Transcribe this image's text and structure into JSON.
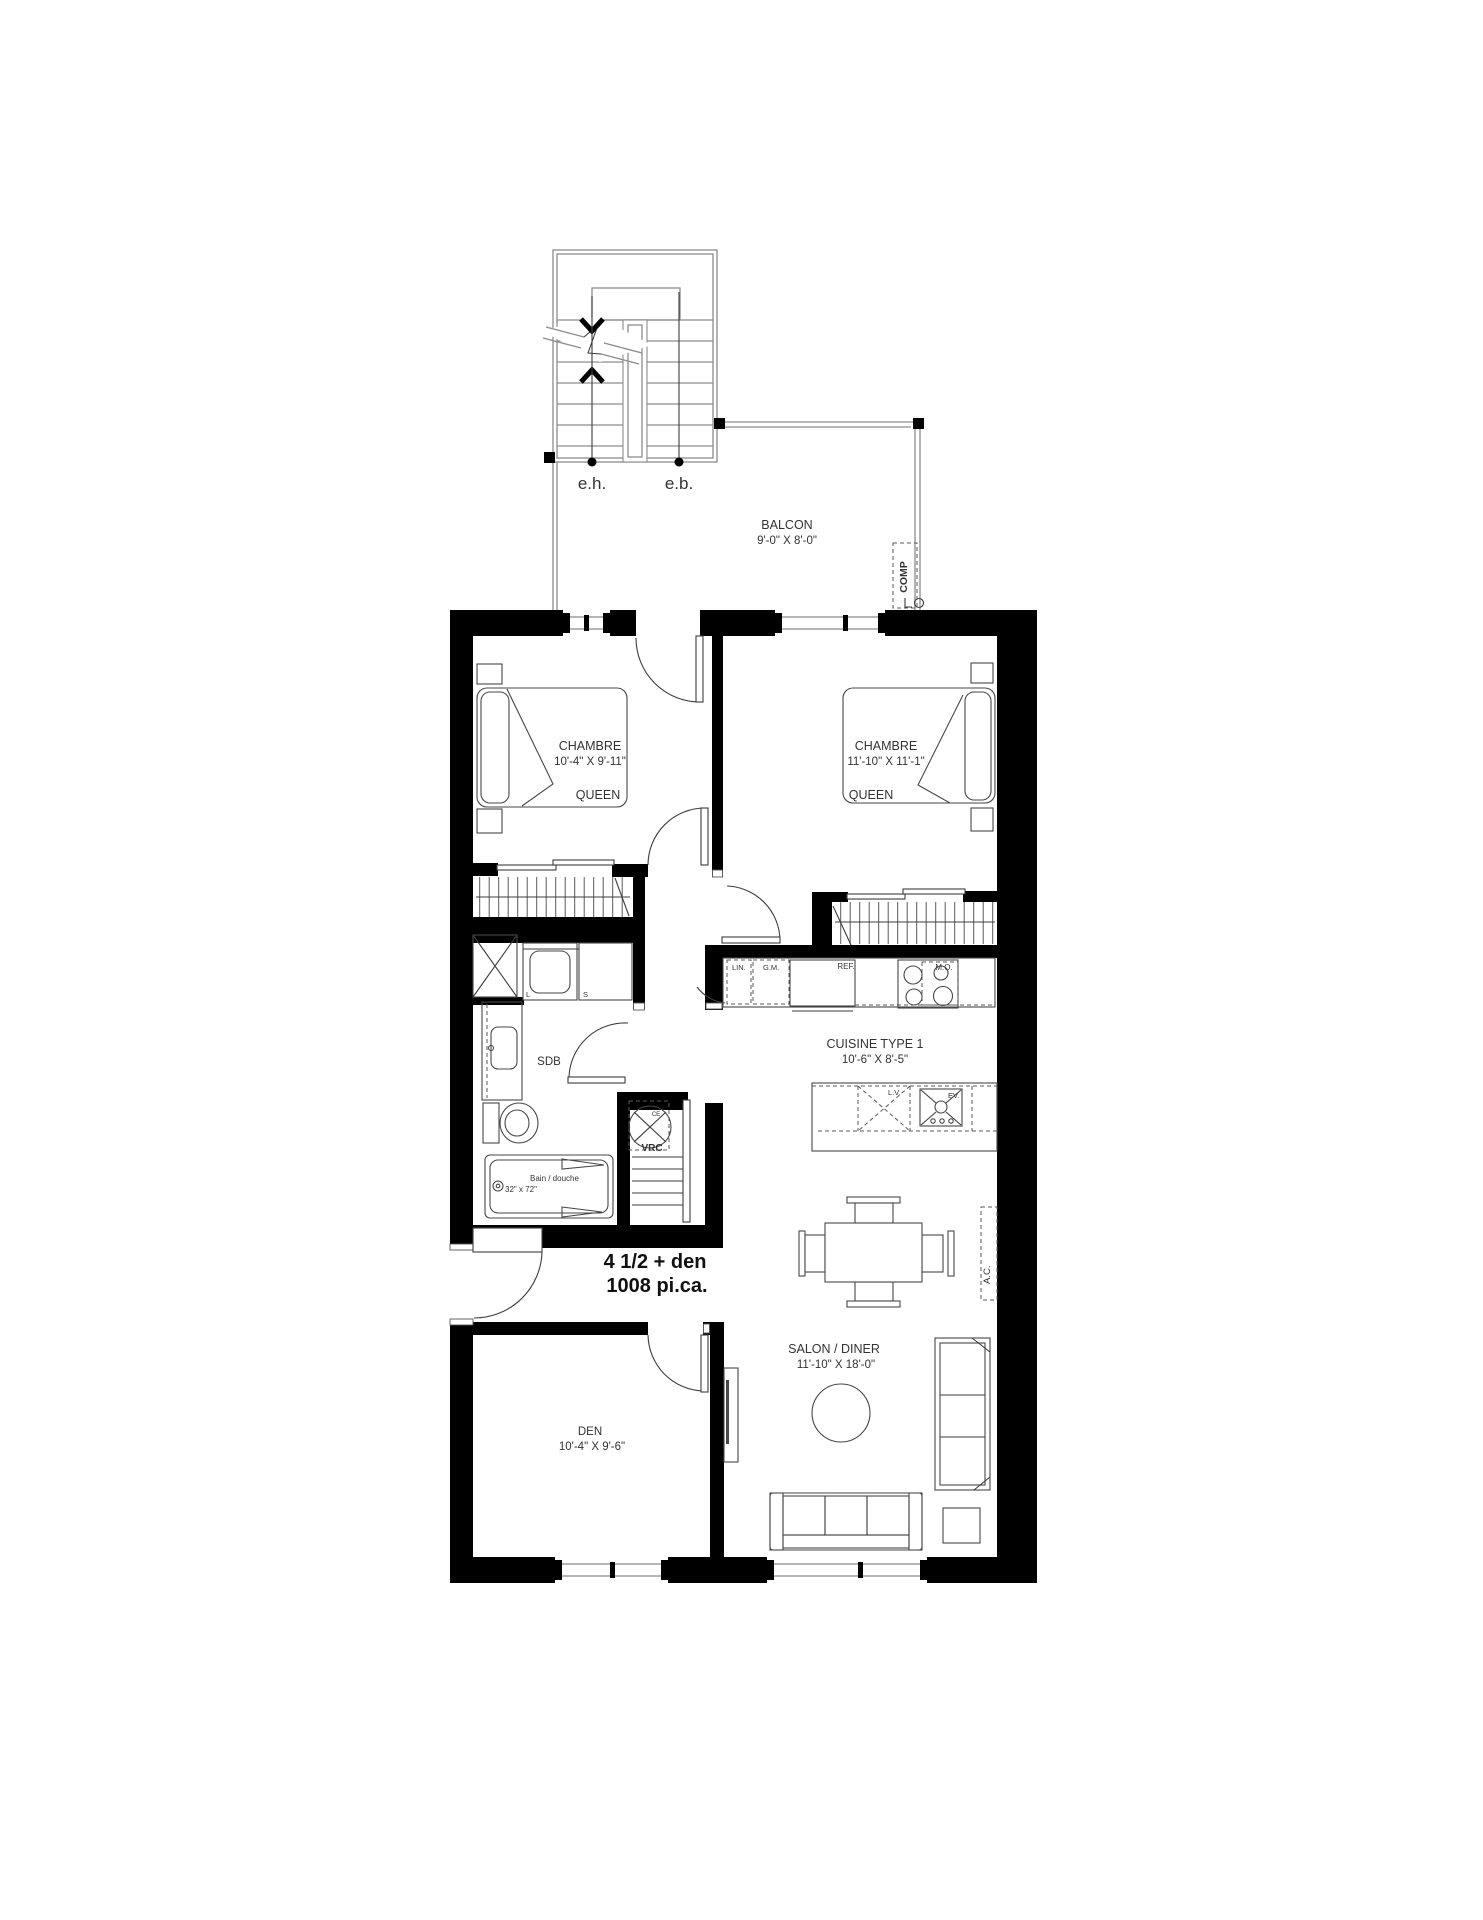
{
  "stairs": {
    "up_label": "e.h.",
    "down_label": "e.b."
  },
  "balcony": {
    "label": "BALCON",
    "dims": "9'-0\" X 8'-0\"",
    "comp": "COMP"
  },
  "rooms": {
    "bedroom1": {
      "label": "CHAMBRE",
      "dims": "10'-4\" X 9'-11\"",
      "bed": "QUEEN"
    },
    "bedroom2": {
      "label": "CHAMBRE",
      "dims": "11'-10\" X 11'-1\"",
      "bed": "QUEEN"
    },
    "bathroom": {
      "label": "SDB",
      "tub_line1": "Bain / douche",
      "tub_line2": "32\" x 72\"",
      "washer": "L",
      "dryer": "S",
      "vrc": "VRC",
      "vrc_tag": "CE"
    },
    "kitchen": {
      "label": "CUISINE TYPE 1",
      "dims": "10'-6\" X 8'-5\"",
      "linen": "LIN.",
      "pantry": "G.M.",
      "fridge": "REF.",
      "microwave": "M.O.",
      "dishwasher": "L.V.",
      "sink": "EV."
    },
    "living": {
      "label": "SALON / DINER",
      "dims": "11'-10\" X 18'-0\"",
      "ac": "A.C."
    },
    "den": {
      "label": "DEN",
      "dims": "10'-4\" X 9'-6\""
    }
  },
  "unit": {
    "type": "4 1/2 + den",
    "area": "1008 pi.ca."
  }
}
